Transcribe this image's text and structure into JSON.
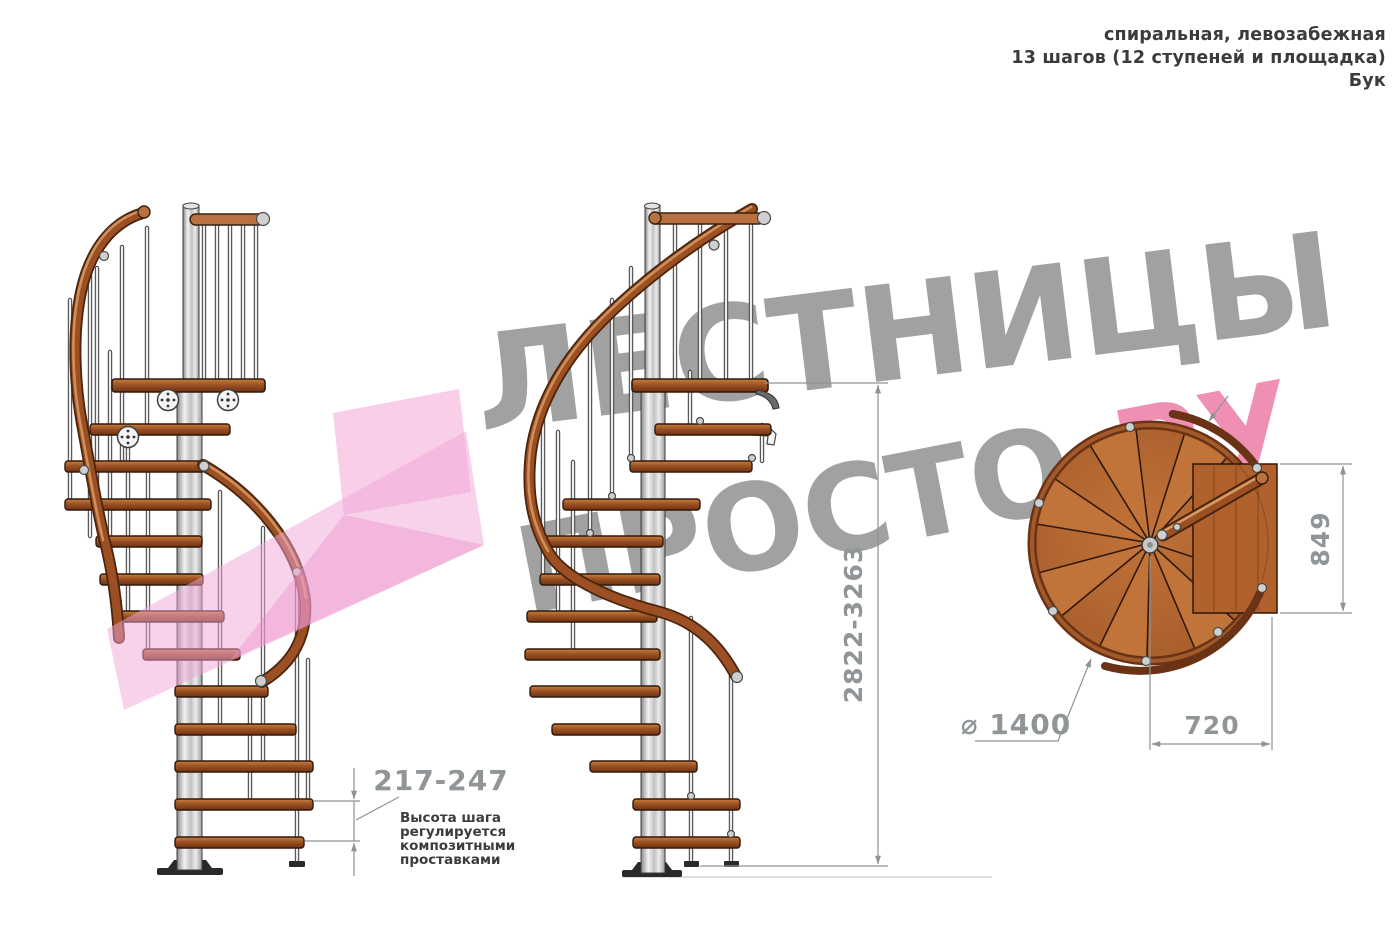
{
  "header": {
    "line1": "спиральная, левозабежная",
    "line2": "13 шагов (12 ступеней и площадка)",
    "line3": "Бук"
  },
  "watermark": {
    "word1": "ЛЕСТНИЦЫ",
    "word2_gray": "ПРОСТО",
    "word2_pink": ".РУ"
  },
  "dimensions": {
    "total_height": "2822-3263",
    "step_height": "217-247",
    "step_height_note": [
      "Высота шага",
      "регулируется",
      "композитными",
      "проставками"
    ],
    "platform_depth": "849",
    "platform_width": "720",
    "diameter": "⌀ 1400"
  },
  "colors": {
    "dimension_gray": "#8e9396",
    "note_text": "#3c3c3c",
    "watermark_gray": "#9d9d9d",
    "watermark_pink": "#ef8fb4",
    "logo_pink": "#f2a5d7",
    "wood": "#9c5224",
    "wood_dark": "#6b3315",
    "metal": "#d9d9d9"
  }
}
